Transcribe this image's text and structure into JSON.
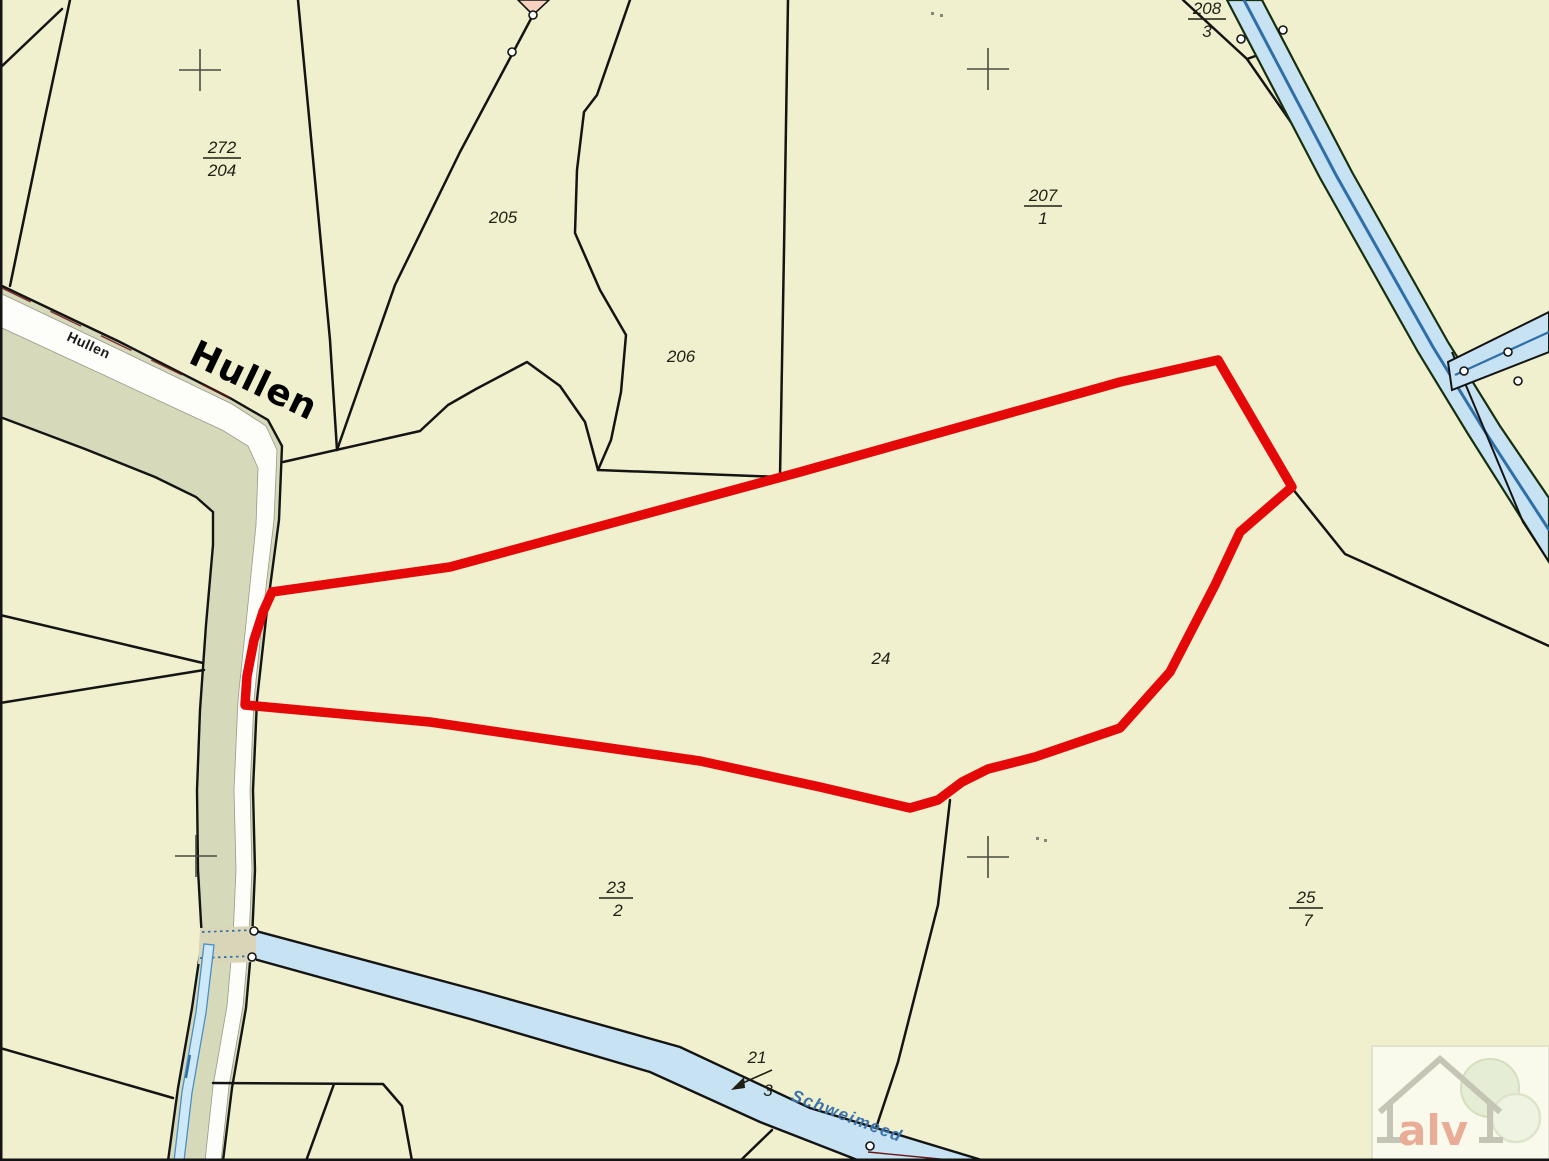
{
  "parcels": {
    "p272_204": {
      "numerator": "272",
      "denominator": "204"
    },
    "p205": {
      "label": "205"
    },
    "p206": {
      "label": "206"
    },
    "p207_1": {
      "numerator": "207",
      "denominator": "1"
    },
    "p208_3": {
      "numerator": "208",
      "denominator": "3"
    },
    "p24": {
      "label": "24"
    },
    "p23_2": {
      "numerator": "23",
      "denominator": "2"
    },
    "p21_3": {
      "numerator": "21",
      "denominator": "3"
    },
    "p25_7": {
      "numerator": "25",
      "denominator": "7"
    }
  },
  "streets": {
    "hullen_large": "Hullen",
    "hullen_small": "Hullen"
  },
  "waterways": {
    "schweimeed": "Schweimeed"
  },
  "highlight": {
    "parcel": "24",
    "color": "#e50808"
  },
  "logo": {
    "text": "alv"
  },
  "colors": {
    "background": "#f0f0cf",
    "water": "#c7e2f2",
    "water_line": "#2f6fa8",
    "road_verge": "#d6d9ba",
    "road_surface": "#fdfdfa",
    "boundary": "#141414"
  }
}
